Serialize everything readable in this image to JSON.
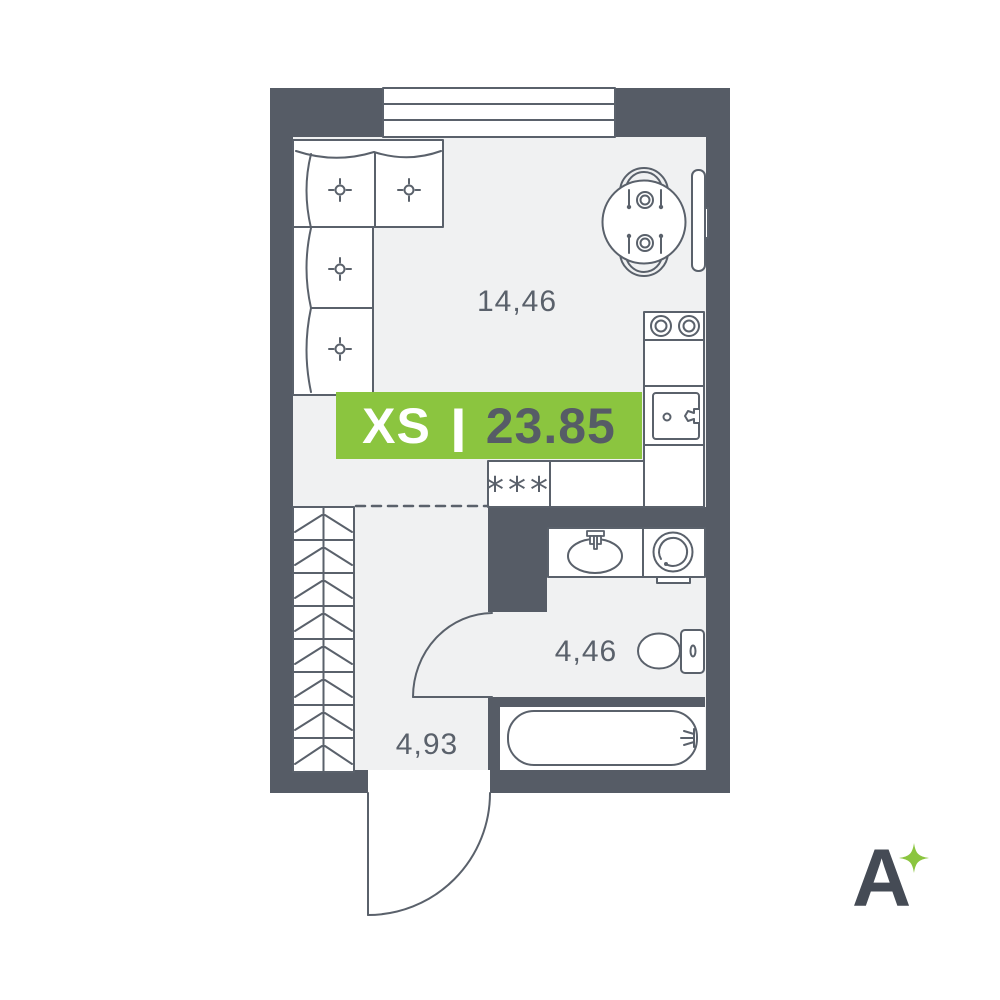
{
  "badge": {
    "size_label": "XS",
    "separator": "|",
    "area_value": "23.85"
  },
  "rooms": {
    "living": {
      "area_label": "14,46"
    },
    "bathroom": {
      "area_label": "4,46"
    },
    "hallway": {
      "area_label": "4,93"
    }
  },
  "symbols": {
    "fridge": "***"
  },
  "logo": {
    "letter": "A"
  },
  "colors": {
    "wall": "#565c66",
    "floor": "#f0f1f2",
    "line": "#5a616b",
    "badge_green": "#8bc53f",
    "badge_text_dark": "#565c66",
    "white": "#ffffff",
    "logo_dark": "#454b55",
    "sparkle_green": "#8bc53f"
  }
}
